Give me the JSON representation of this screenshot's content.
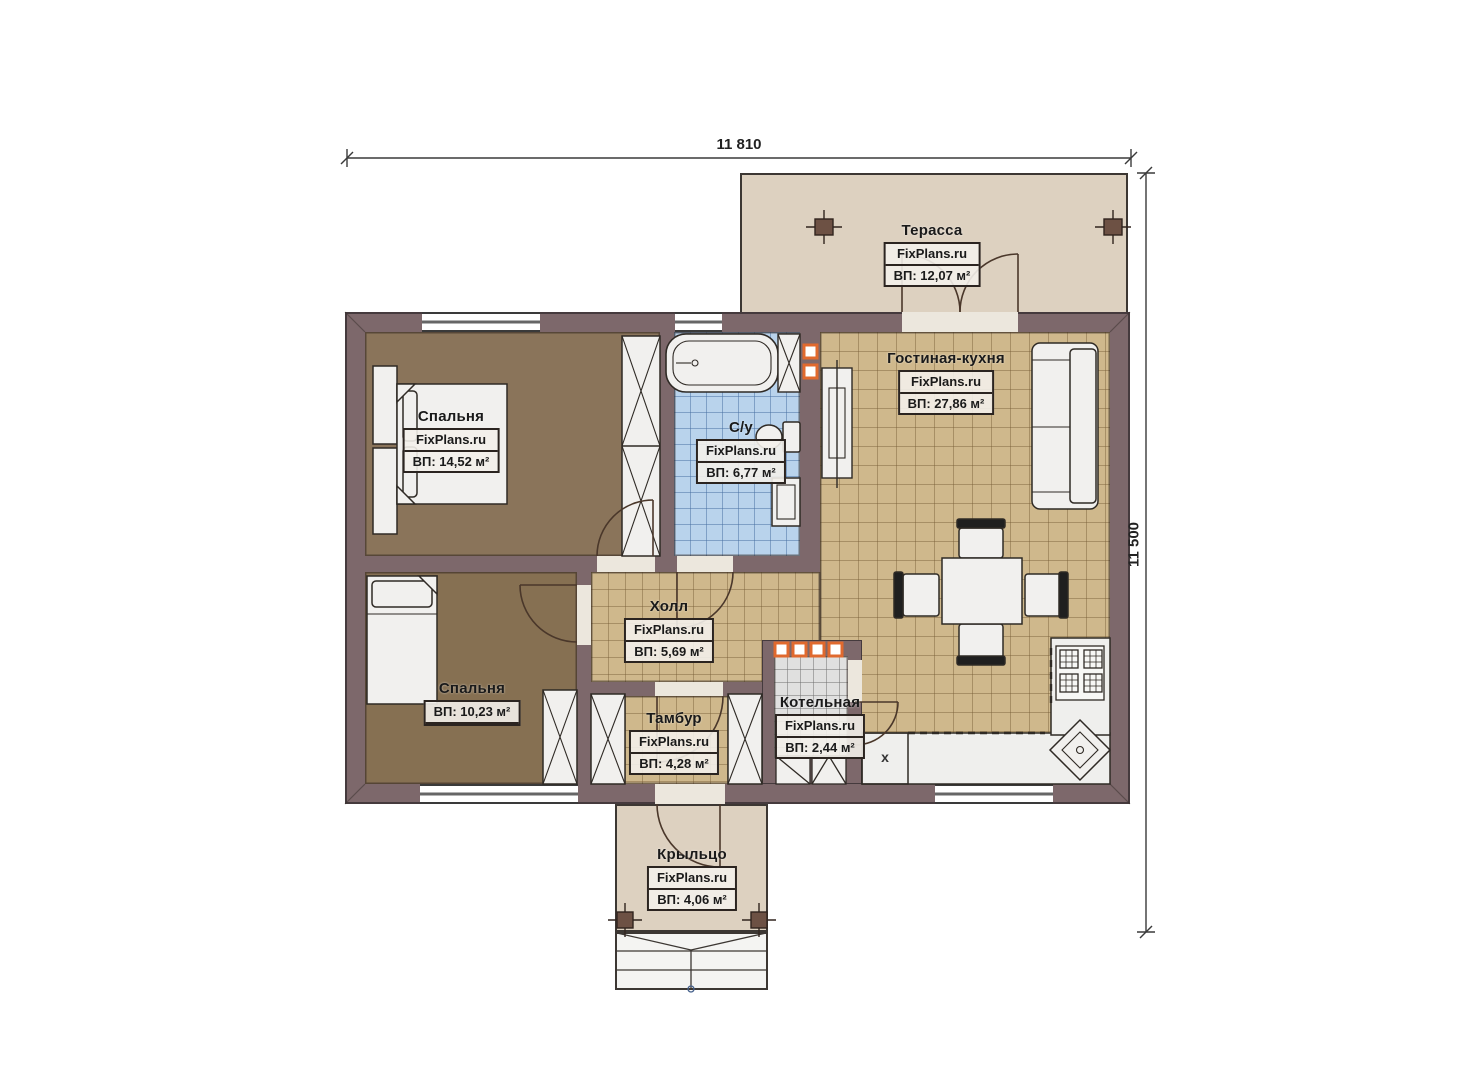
{
  "plan": {
    "type": "single-storey house floor plan",
    "dimensions": {
      "width_label": "11 810",
      "height_label": "11 500"
    },
    "watermark": "FixPlans.ru"
  },
  "rooms": [
    {
      "id": "terrace",
      "name": "Терасса",
      "area": "ВП: 12,07 м²"
    },
    {
      "id": "living-kitchen",
      "name": "Гостиная-кухня",
      "area": "ВП: 27,86 м²"
    },
    {
      "id": "bedroom-1",
      "name": "Спальня",
      "area": "ВП: 14,52 м²"
    },
    {
      "id": "bathroom",
      "name": "С/у",
      "area": "ВП: 6,77 м²"
    },
    {
      "id": "hall",
      "name": "Холл",
      "area": "ВП: 5,69 м²"
    },
    {
      "id": "bedroom-2",
      "name": "Спальня",
      "area": "ВП: 10,23 м²"
    },
    {
      "id": "vestibule",
      "name": "Тамбур",
      "area": "ВП: 4,28 м²"
    },
    {
      "id": "boiler",
      "name": "Котельная",
      "area": "ВП: 2,44 м²"
    },
    {
      "id": "porch",
      "name": "Крыльцо",
      "area": "ВП: 4,06 м²"
    }
  ],
  "marks": {
    "kitchen_cabinet": "x"
  },
  "colors": {
    "wall": "#7d686b",
    "floor_bedroom": "#8a745a",
    "floor_bedroom2": "#867052",
    "tile_tan": "#cfb88c",
    "tile_bath": "#b9d3ec",
    "tile_boiler": "#e0e0df",
    "outdoor": "#ddd1c0",
    "accent_orange": "#e0692e"
  }
}
